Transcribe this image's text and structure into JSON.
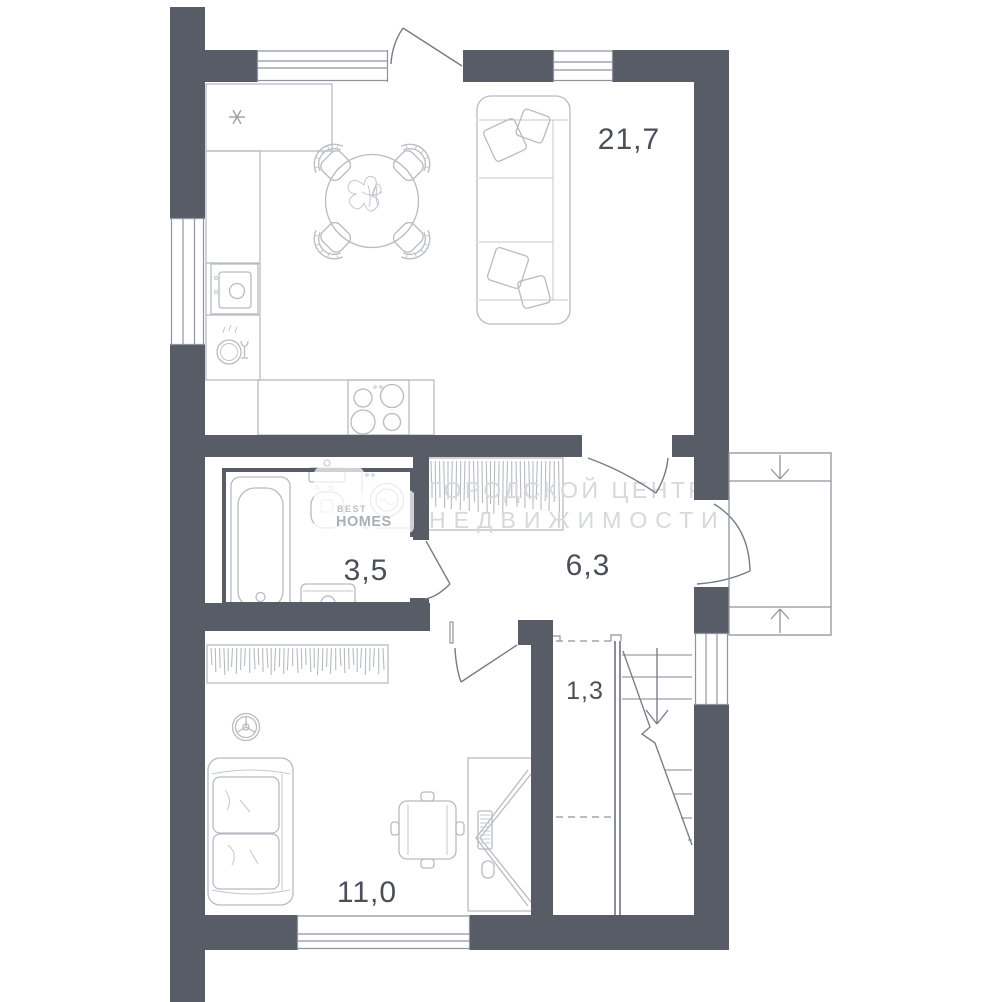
{
  "floor_plan": {
    "watermark": {
      "line1": "ГОРОДСКОЙ ЦЕНТР",
      "line2": "НЕДВИЖИМОСТИ"
    },
    "logo": {
      "line1": "BEST",
      "line2": "HOMES"
    },
    "rooms": {
      "living_kitchen": {
        "area": "21,7"
      },
      "bathroom": {
        "area": "3,5"
      },
      "hallway": {
        "area": "6,3"
      },
      "stairs_closet": {
        "area": "1,3"
      },
      "bedroom": {
        "area": "11,0"
      }
    },
    "colors": {
      "wall": "#575c66",
      "furniture_line": "#b7bbc2",
      "label": "#4b5058",
      "watermark": "#d6d8db"
    }
  }
}
